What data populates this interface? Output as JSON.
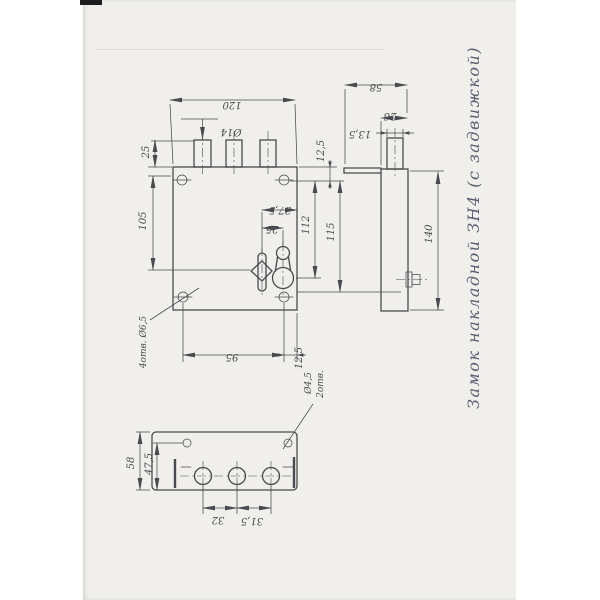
{
  "title": "Замок накладной  ЗН4  (с задвижкой)",
  "colors": {
    "line": "#494a4e",
    "ink": "#596074",
    "page": "#f0efeb"
  },
  "front_view": {
    "dim_width": "120",
    "dim_bolt_dia": "Ø14",
    "dim_bolt_protrusion": "25",
    "dim_top_to_spindle": "105",
    "dim_spindle_to_edge": "37,5",
    "dim_spindle_to_keyhole": "25",
    "dim_top_to_keyhole": "112",
    "dim_screws_vertical": "115",
    "dim_screw_inset_top": "12,5",
    "dim_screws_horizontal": "95",
    "dim_screw_inset_side": "12,5",
    "label_screw_holes": "4отв. Ø6,5"
  },
  "side_view": {
    "dim_total_depth": "58",
    "dim_body_depth": "26",
    "dim_bolt_depth": "13,5",
    "dim_height": "140"
  },
  "bottom_view": {
    "dim_plate_width": "58",
    "dim_screw_offset": "47,5",
    "dim_bolt_spacing_left": "32",
    "dim_bolt_spacing_right": "31,5",
    "label_holes_dia": "Ø4,5",
    "label_holes_count": "2отв."
  }
}
